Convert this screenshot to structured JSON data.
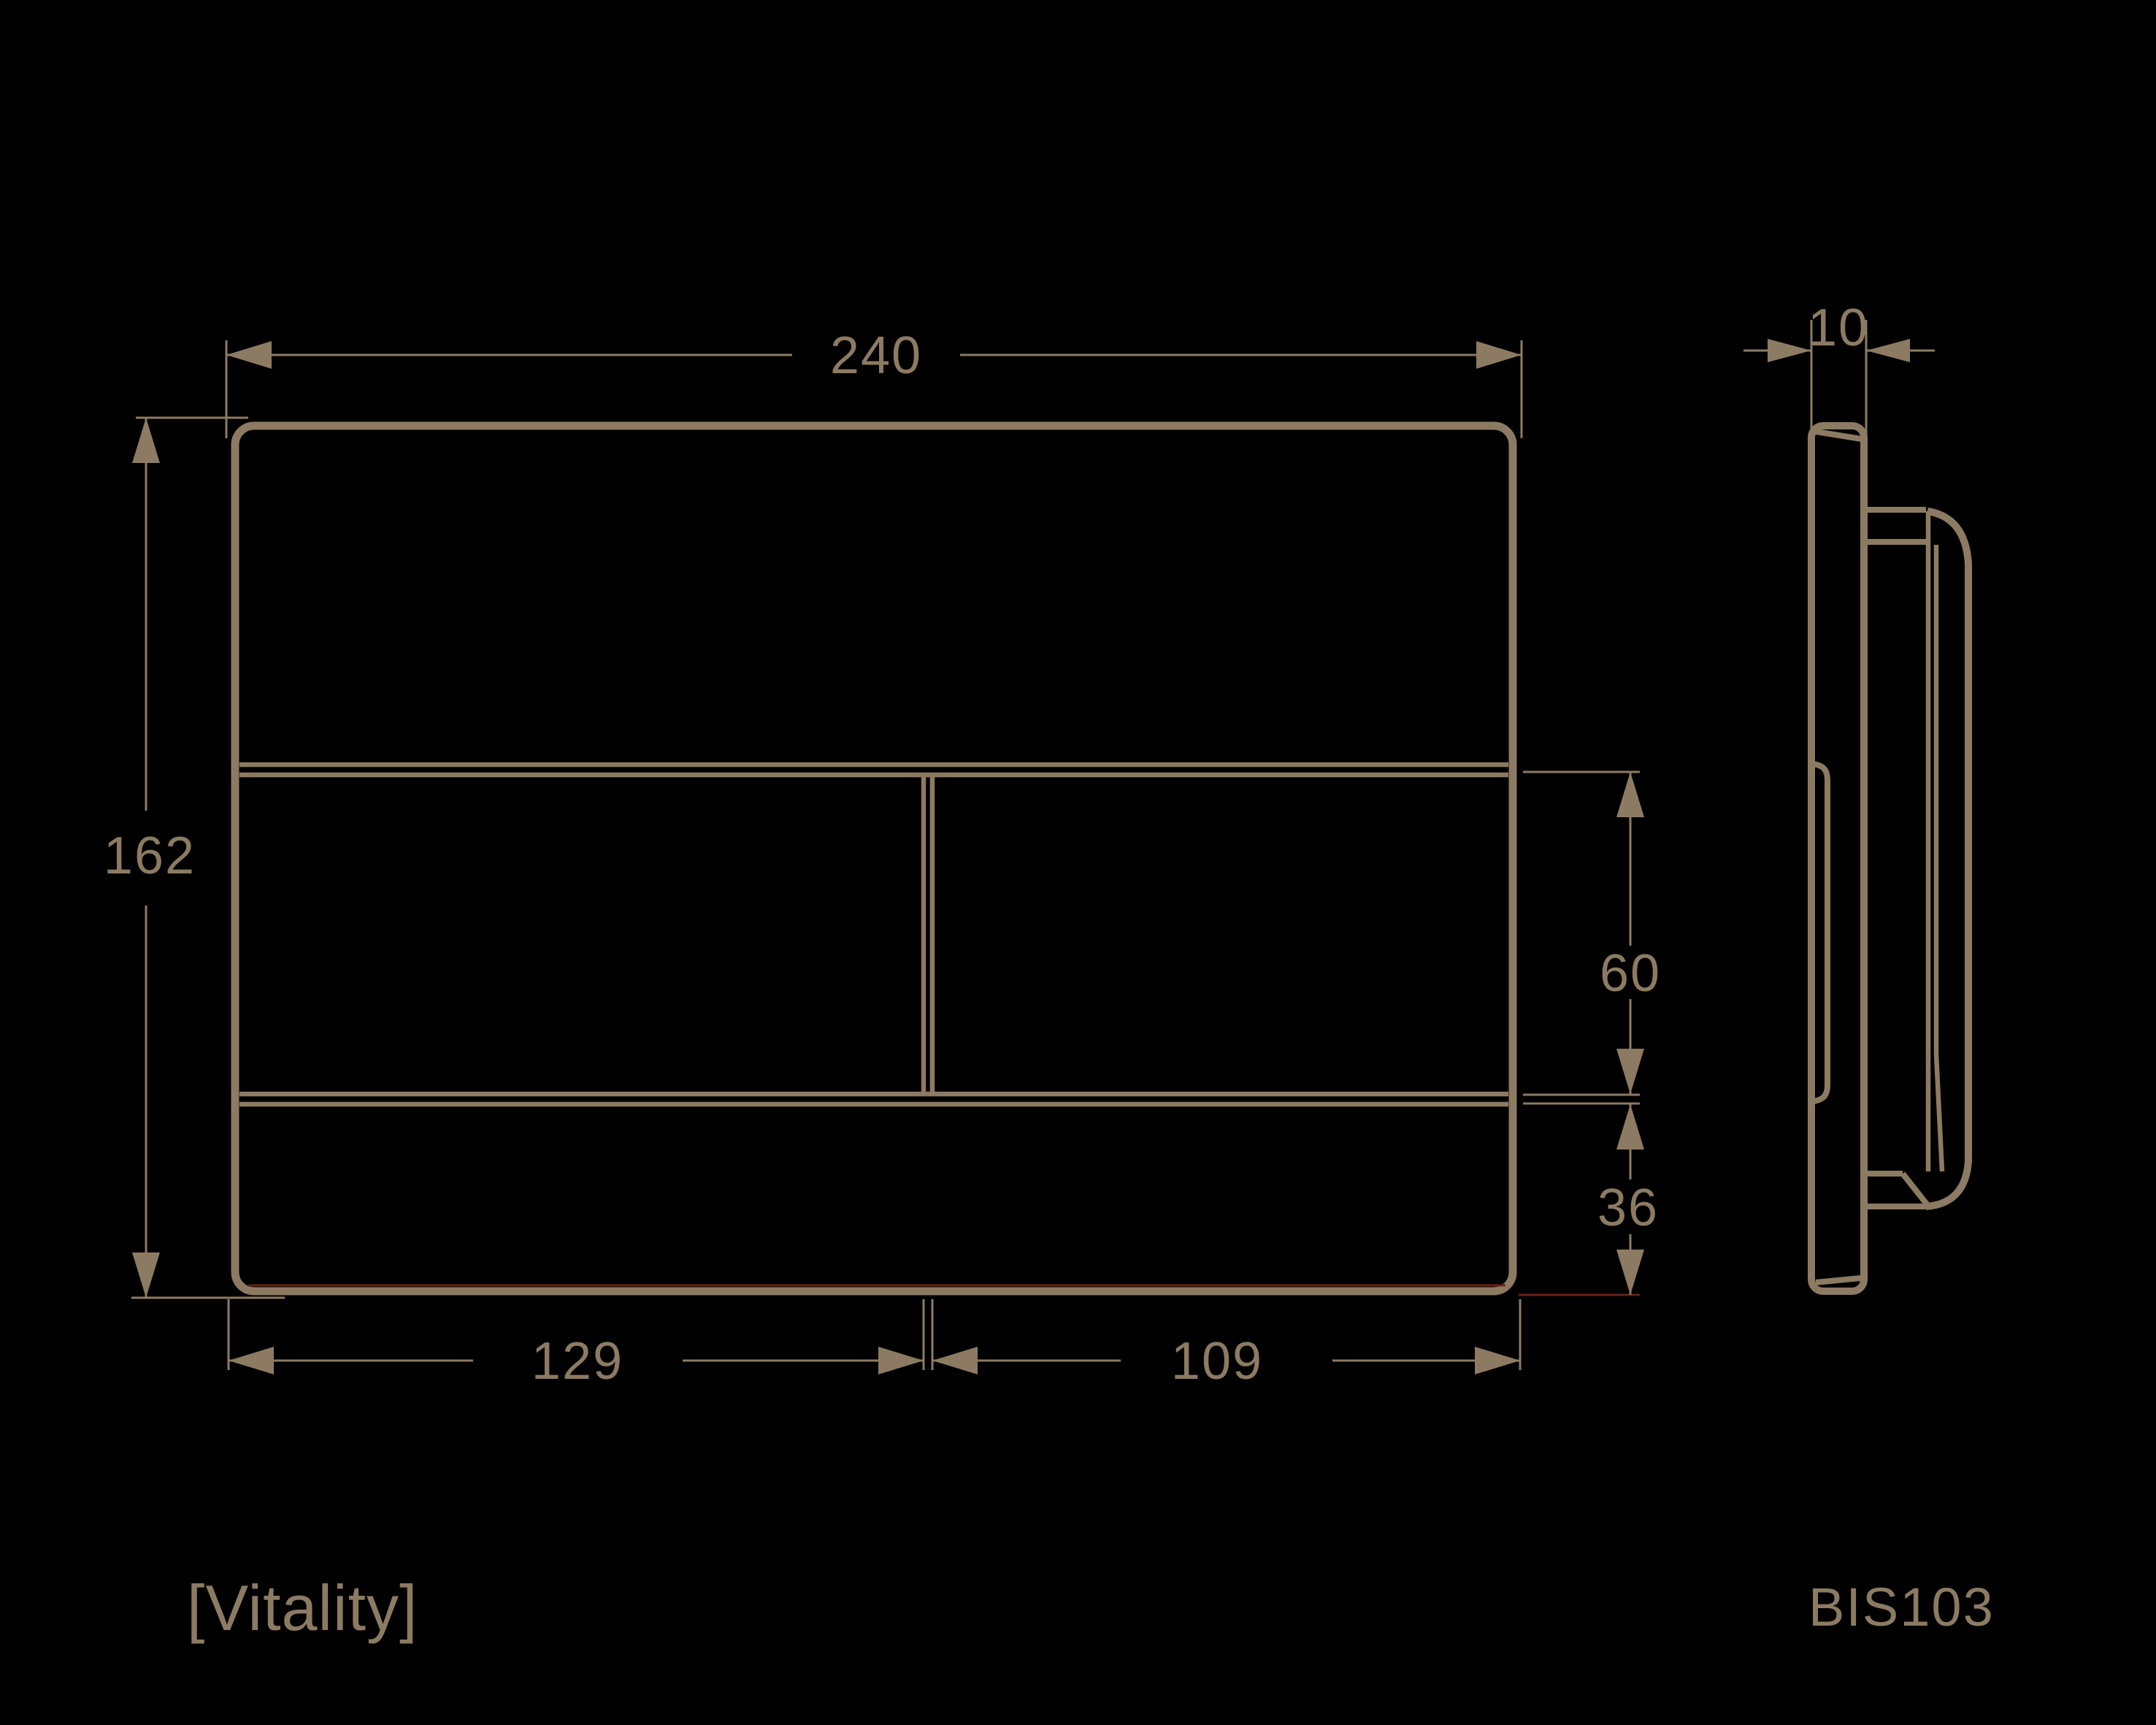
{
  "colors": {
    "background": "#000000",
    "line": "#8C7B62",
    "accent-red": "#6E2015"
  },
  "product": {
    "name": "[Vitality]",
    "code": "BIS103"
  },
  "dimensions": {
    "overall_width": "240",
    "overall_height": "162",
    "panel_depth": "10",
    "button_row_height": "60",
    "bottom_row_height": "36",
    "left_button_width": "129",
    "right_button_width": "109"
  }
}
